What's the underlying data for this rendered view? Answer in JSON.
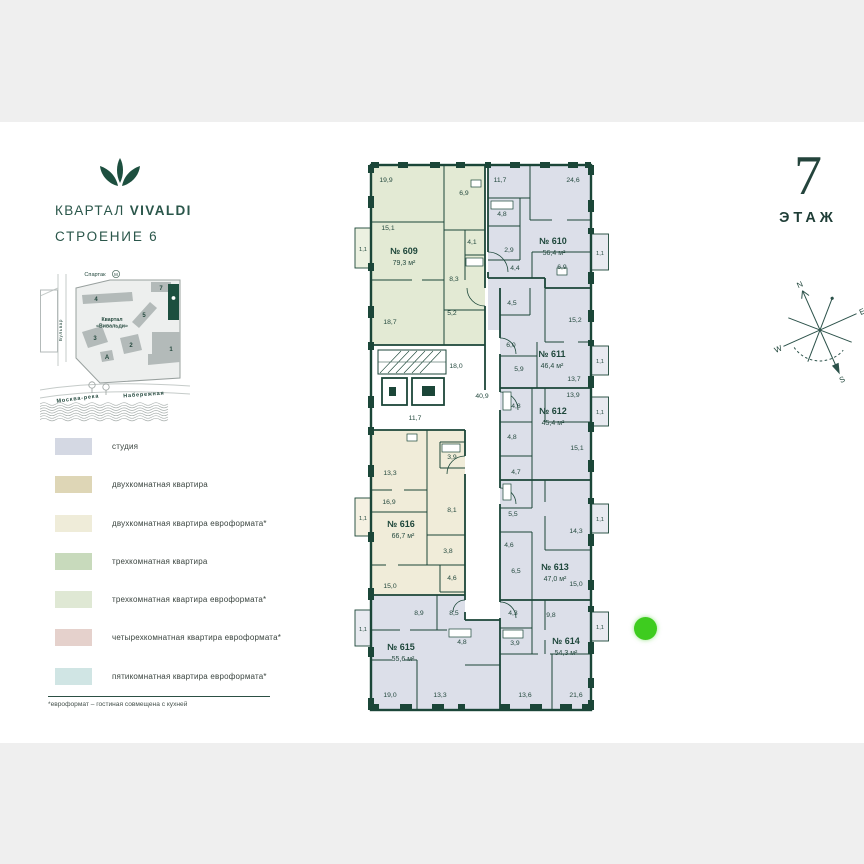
{
  "header": {
    "project": "КВАРТАЛ",
    "brand": "VIVALDI",
    "building": "СТРОЕНИЕ 6"
  },
  "floor": {
    "number": "7",
    "label": "ЭТАЖ"
  },
  "site_map": {
    "metro_label": "Спартак",
    "metro_icon": "М",
    "quarter_line1": "Квартал",
    "quarter_line2": "«Вивальди»",
    "street": "Бульвар",
    "river": "Москва-река",
    "embankment": "Набережная",
    "b1": "1",
    "b2": "2",
    "b3": "3",
    "b4": "4",
    "b5": "5",
    "b7": "7",
    "ba": "А"
  },
  "legend": {
    "items": [
      {
        "label": "студия",
        "color": "#d4d8e3"
      },
      {
        "label": "двухкомнатная квартира",
        "color": "#ded6b6"
      },
      {
        "label": "двухкомнатная квартира евроформата*",
        "color": "#efecd9"
      },
      {
        "label": "трехкомнатная квартира",
        "color": "#c8dabc"
      },
      {
        "label": "трехкомнатная квартира евроформата*",
        "color": "#dfe8d4"
      },
      {
        "label": "четырехкомнатная квартира евроформата*",
        "color": "#e5d1cc"
      },
      {
        "label": "пятикомнатная квартира евроформата*",
        "color": "#d0e5e4"
      }
    ],
    "footnote": "*евроформат – гостиная совмещена с кухней"
  },
  "plan": {
    "apartments": [
      {
        "num": "№ 609",
        "area": "79,3 м²"
      },
      {
        "num": "№ 610",
        "area": "56,4 м²"
      },
      {
        "num": "№ 611",
        "area": "46,4 м²"
      },
      {
        "num": "№ 612",
        "area": "45,4 м²"
      },
      {
        "num": "№ 613",
        "area": "47,0 м²"
      },
      {
        "num": "№ 614",
        "area": "54,3 м²"
      },
      {
        "num": "№ 615",
        "area": "55,6 м²"
      },
      {
        "num": "№ 616",
        "area": "66,7 м²"
      }
    ],
    "rooms": {
      "r609": [
        "19,9",
        "6,9",
        "15,1",
        "4,1",
        "8,3",
        "5,2",
        "18,7"
      ],
      "r610": [
        "11,7",
        "24,6",
        "4,8",
        "2,9",
        "4,4",
        "6,9"
      ],
      "r611": [
        "4,5",
        "15,2",
        "6,0",
        "5,9",
        "13,7"
      ],
      "r612": [
        "13,9",
        "4,8",
        "4,8",
        "15,1",
        "4,7"
      ],
      "r613": [
        "5,5",
        "14,3",
        "4,6",
        "6,5",
        "15,0"
      ],
      "r614": [
        "4,3",
        "9,8",
        "3,9",
        "13,6",
        "21,6"
      ],
      "r615": [
        "8,9",
        "8,5",
        "4,8",
        "19,0",
        "13,3"
      ],
      "r616": [
        "13,3",
        "3,9",
        "16,9",
        "8,1",
        "3,8",
        "4,6",
        "15,0"
      ]
    },
    "common": {
      "stairs": "18,0",
      "corridor": "40,9",
      "lobby": "11,7"
    },
    "balcony": "1,1"
  },
  "compass": {
    "n": "N",
    "e": "E",
    "s": "S",
    "w": "W"
  },
  "marker": {
    "color": "#3ecc1f"
  },
  "colors": {
    "apt_studio": "#dcdfe9",
    "apt_2room_euro": "#f0ecd9",
    "apt_3room_euro": "#e3ead4",
    "wall": "#1b4638",
    "brand": "#1d4f3f"
  }
}
